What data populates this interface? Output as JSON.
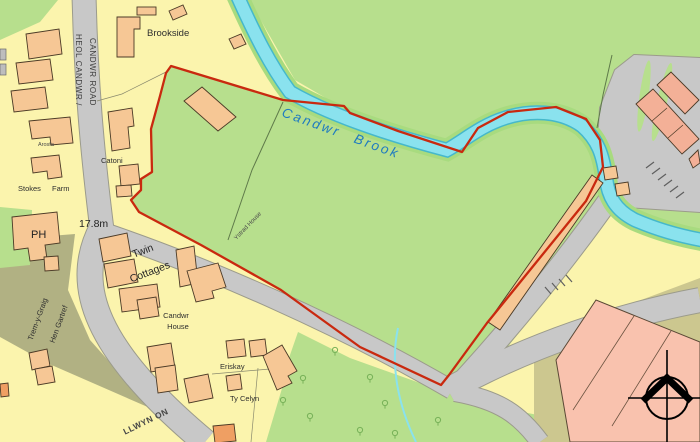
{
  "map": {
    "description": "Ordnance Survey style site location plan, Candwr Brook area, with red site boundary outline",
    "labels": {
      "brookside": "Brookside",
      "heol_candwr_line1": "HEOL CANDWR /",
      "heol_candwr_line2": "CANDWR ROAD",
      "candwr_brook": "Candwr Brook",
      "arosfa": "Arosfa",
      "catoni": "Catoni",
      "stokes": "Stokes",
      "farm": "Farm",
      "ph": "PH",
      "spot_height": "17.8m",
      "twin_line1": "Twin",
      "twin_line2": "Cottages",
      "trem_y_graig": "Trem-y-Graig",
      "hen_gartref": "Hen Gartref",
      "candwr_house_line1": "Candwr",
      "candwr_house_line2": "House",
      "ystrad_house": "Ystrad House",
      "eriskay": "Eriskay",
      "ty_celyn": "Ty Celyn",
      "llwyn_on": "LLWYN ON"
    },
    "palette": {
      "background_yellow": "#fbf4ad",
      "field_green": "#b7df8d",
      "brook_cyan": "#8ae2ee",
      "brook_edge": "#45b8cb",
      "road_gray": "#c8c8c8",
      "building_tan": "#f6c795",
      "building_salmon": "#f3b097",
      "building_orange": "#ef9f63",
      "court_pink": "#f9c2ae",
      "olive": "#b1b183",
      "khaki": "#ccc78f",
      "boundary_red": "#c9290f",
      "brook_label_blue": "#1e7bc0"
    }
  }
}
